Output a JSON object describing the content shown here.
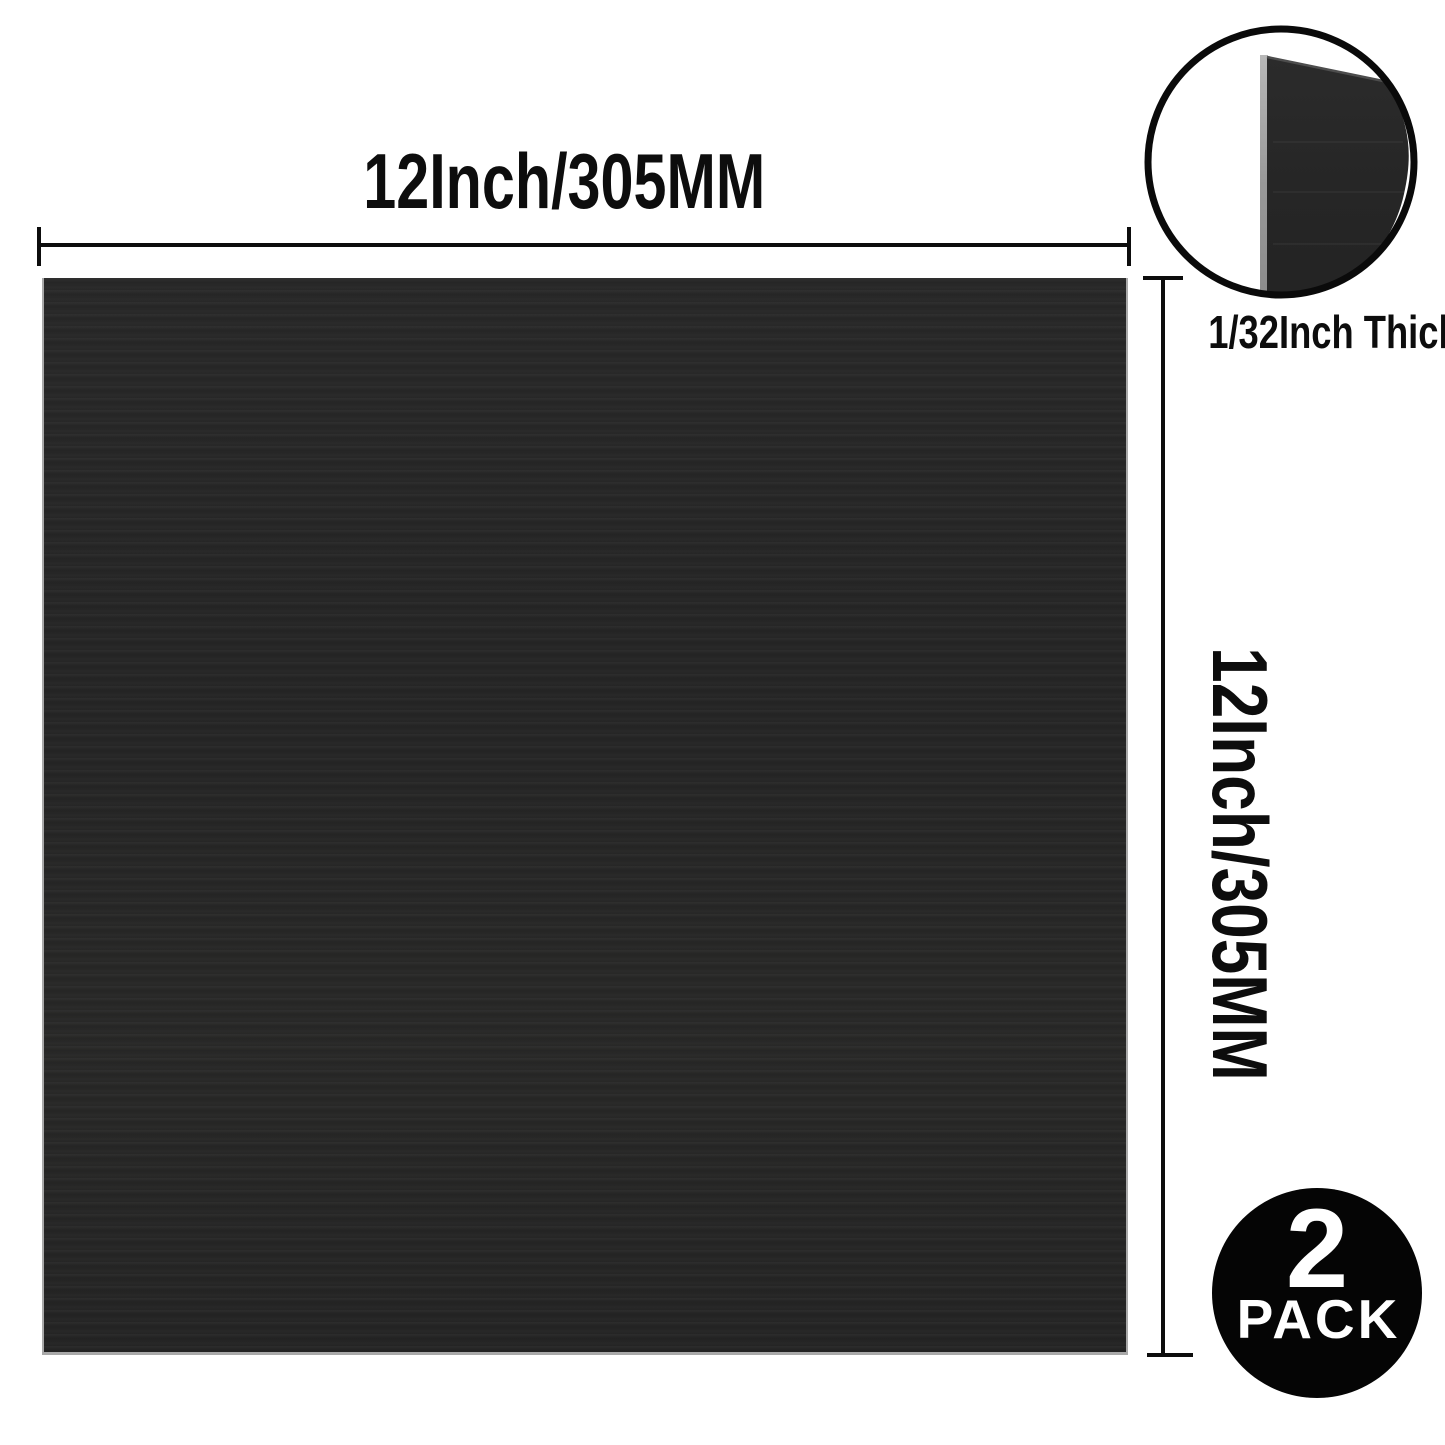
{
  "diagram": {
    "type": "product-dimension-diagram",
    "product": "black sheet"
  },
  "labels": {
    "width": "12Inch/305MM",
    "height": "12Inch/305MM",
    "thickness": "1/32Inch Thick"
  },
  "badge": {
    "count": "2",
    "word": "PACK"
  },
  "colors": {
    "ink": "#0d0d0d",
    "sheet": "#262626",
    "edge": "#a9a9a9",
    "inset_stroke": "#0a0a0a",
    "inset_thickness_edge": "#9e9e9e",
    "badge_bg": "#050505",
    "badge_text": "#ffffff"
  }
}
